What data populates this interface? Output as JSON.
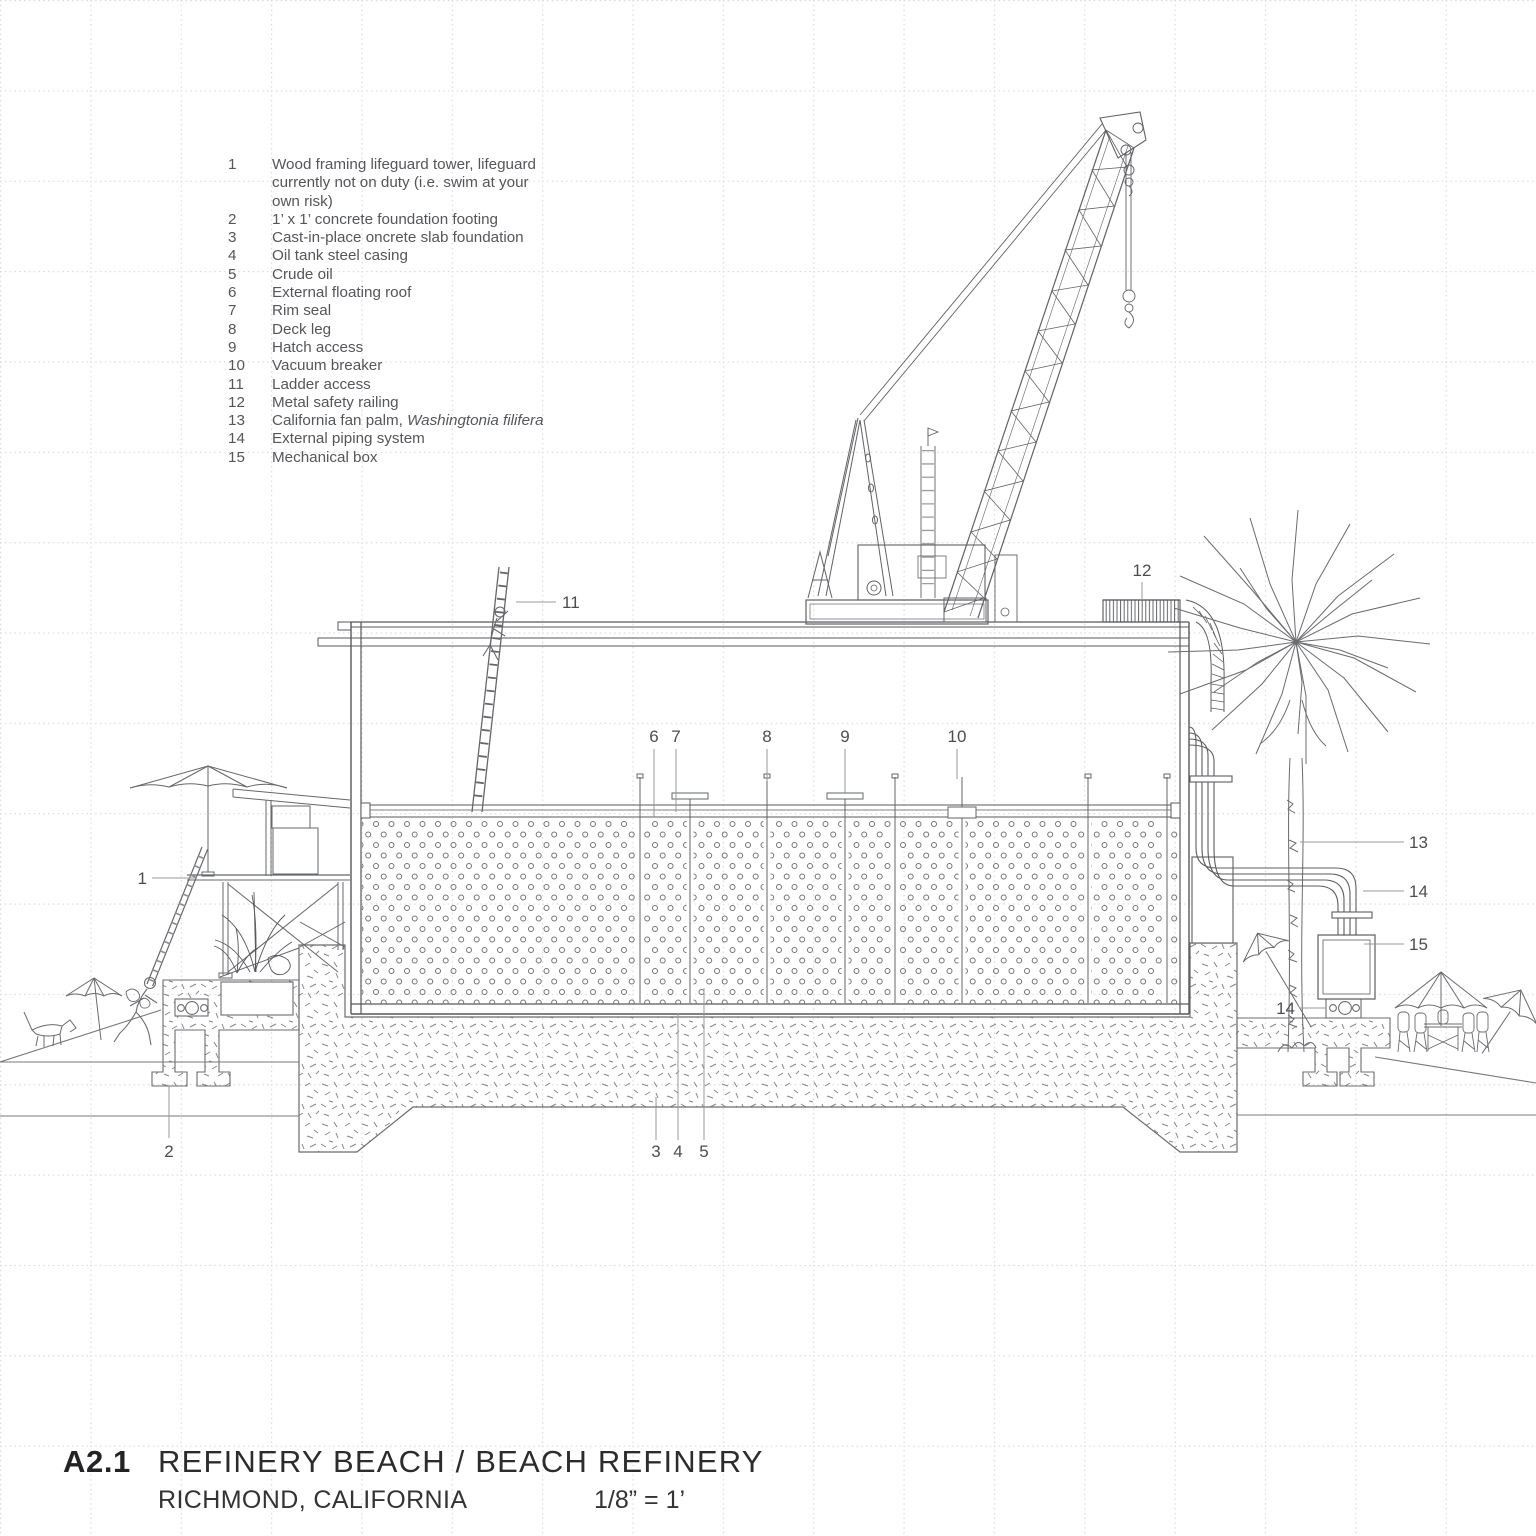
{
  "meta": {
    "sheet_no": "A2.1",
    "title": "REFINERY BEACH / BEACH REFINERY",
    "location": "RICHMOND, CALIFORNIA",
    "scale": "1/8” = 1’"
  },
  "legend": {
    "items": [
      {
        "num": "1",
        "text": "Wood framing lifeguard tower, lifeguard currently not on duty (i.e. swim at your own risk)"
      },
      {
        "num": "2",
        "text": "1’ x 1’ concrete foundation footing"
      },
      {
        "num": "3",
        "text": "Cast-in-place oncrete slab foundation"
      },
      {
        "num": "4",
        "text": "Oil tank steel casing"
      },
      {
        "num": "5",
        "text": "Crude oil"
      },
      {
        "num": "6",
        "text": "External floating roof"
      },
      {
        "num": "7",
        "text": "Rim seal"
      },
      {
        "num": "8",
        "text": "Deck leg"
      },
      {
        "num": "9",
        "text": "Hatch access"
      },
      {
        "num": "10",
        "text": "Vacuum breaker"
      },
      {
        "num": "11",
        "text": "Ladder access"
      },
      {
        "num": "12",
        "text": "Metal safety railing"
      },
      {
        "num": "13",
        "text": "California fan palm, ",
        "italic": "Washingtonia filifera"
      },
      {
        "num": "14",
        "text": "External piping system"
      },
      {
        "num": "15",
        "text": "Mechanical box"
      }
    ]
  },
  "drawing": {
    "callouts": [
      "1",
      "2",
      "3",
      "4",
      "5",
      "6",
      "7",
      "8",
      "9",
      "10",
      "11",
      "12",
      "13",
      "14",
      "15",
      "14"
    ]
  },
  "colors": {
    "linework": "#595a5e",
    "light_line": "#8a8b8d",
    "grid": "#d7d7d9",
    "text": "#55565a",
    "title_text": "#232325"
  }
}
